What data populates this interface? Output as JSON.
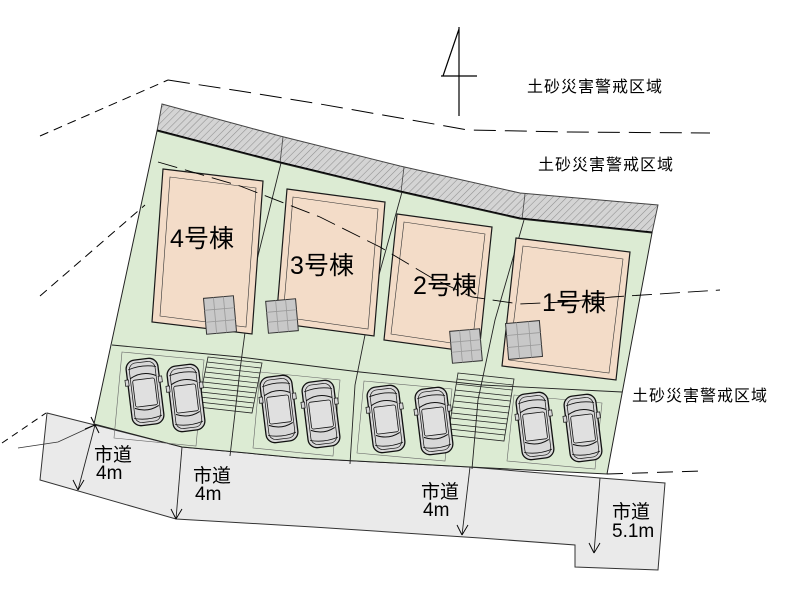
{
  "site_plan": {
    "warning_zones": {
      "top": "土砂災害警戒区域",
      "middle": "土砂災害警戒区域",
      "right": "土砂災害警戒区域"
    },
    "buildings": [
      {
        "label": "4号棟"
      },
      {
        "label": "3号棟"
      },
      {
        "label": "2号棟"
      },
      {
        "label": "1号棟"
      }
    ],
    "roads": [
      {
        "name": "市道",
        "width": "4m"
      },
      {
        "name": "市道",
        "width": "4m"
      },
      {
        "name": "市道",
        "width": "4m"
      },
      {
        "name": "市道",
        "width": "5.1m"
      }
    ],
    "parking": {
      "car_count": 8
    },
    "icons": {
      "north_arrow": "north-arrow-icon",
      "car": "car-icon",
      "stairs": "stairs-icon",
      "boundary_cross": "boundary-cross-icon"
    },
    "colors": {
      "lot_green": "#dcebd3",
      "building_tan": "#f3dcc8",
      "road_gray": "#eaeaea",
      "slope_gray": "#d4d4d4",
      "hatch_line": "#8f8f8f",
      "terrace_gray": "#c8c8c8",
      "car_gray": "#d8d8d8"
    }
  }
}
